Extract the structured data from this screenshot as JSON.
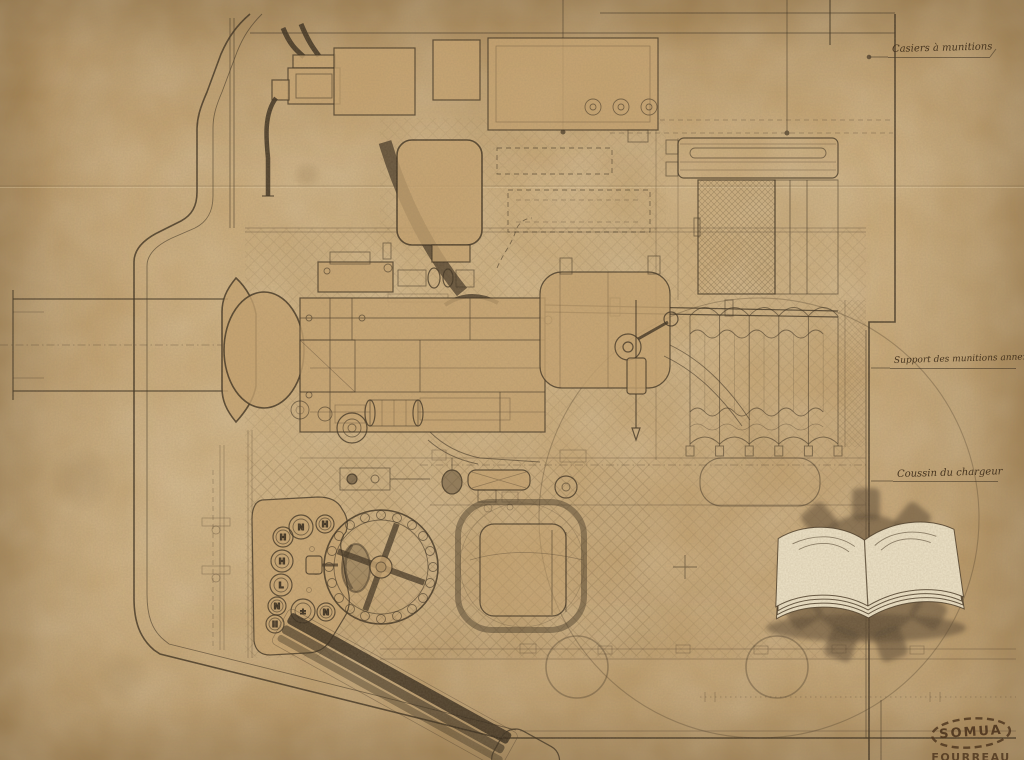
{
  "annotations": {
    "casiers": "Casiers à munitions",
    "support": "Support des munitions annexées",
    "coussin": "Coussin du chargeur"
  },
  "stamp": {
    "name": "SOMUA",
    "subtext": "FOURREAU"
  },
  "gauges": {
    "letters": [
      "N",
      "H",
      "H",
      "H",
      "L",
      "N",
      "II",
      "±",
      "N"
    ]
  },
  "watermark": {
    "icons": [
      "open-book-icon",
      "gear-icon"
    ]
  },
  "colors": {
    "paper": "#c29e6a",
    "ink": "#3a2e1f",
    "stamp": "#4a321c",
    "book_pages": "#eee3c8",
    "watermark_shadow": "#5c4a34"
  }
}
